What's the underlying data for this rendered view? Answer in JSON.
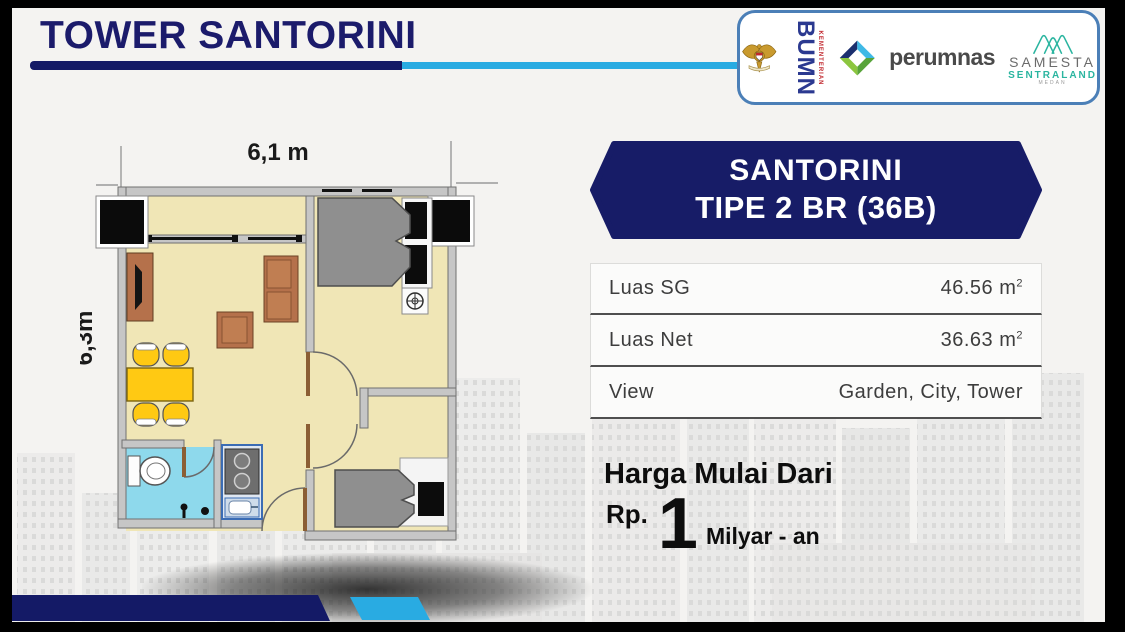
{
  "slide_title": "TOWER SANTORINI",
  "floorplan": {
    "width_label": "6,1 m",
    "height_label": "6,3m"
  },
  "unit_banner": {
    "line1": "SANTORINI",
    "line2": "TIPE 2 BR (36B)"
  },
  "spec_table": {
    "rows": [
      {
        "label": "Luas SG",
        "value": "46.56 m",
        "sup": "2"
      },
      {
        "label": "Luas Net",
        "value": "36.63 m",
        "sup": "2"
      },
      {
        "label": "View",
        "value": "Garden, City, Tower",
        "sup": ""
      }
    ]
  },
  "price": {
    "heading": "Harga Mulai Dari",
    "currency": "Rp.",
    "amount": "1",
    "unit": "Milyar - an"
  },
  "logos": {
    "bumn_ministry": "KEMENTERIAN",
    "bumn": "BUMN",
    "perumnas": "perumnas",
    "samesta": "SAMESTA",
    "samesta_sub": "SENTRALAND",
    "samesta_city": "MEDAN"
  },
  "colors": {
    "navy": "#141a66",
    "cyan": "#29abe2",
    "title_navy": "#1b1b6b",
    "floor_cream": "#f0e6b6",
    "bathroom_blue": "#8ed9ec",
    "furniture_brown": "#b5714b",
    "dining_yellow": "#ffc913",
    "bed_gray": "#8f8f8f",
    "samesta_teal": "#2bb5a0",
    "perumnas_lightblue": "#3fb9e6",
    "perumnas_green": "#8cc63f",
    "bumn_blue": "#2b3990",
    "garuda_gold": "#c99a2e"
  }
}
